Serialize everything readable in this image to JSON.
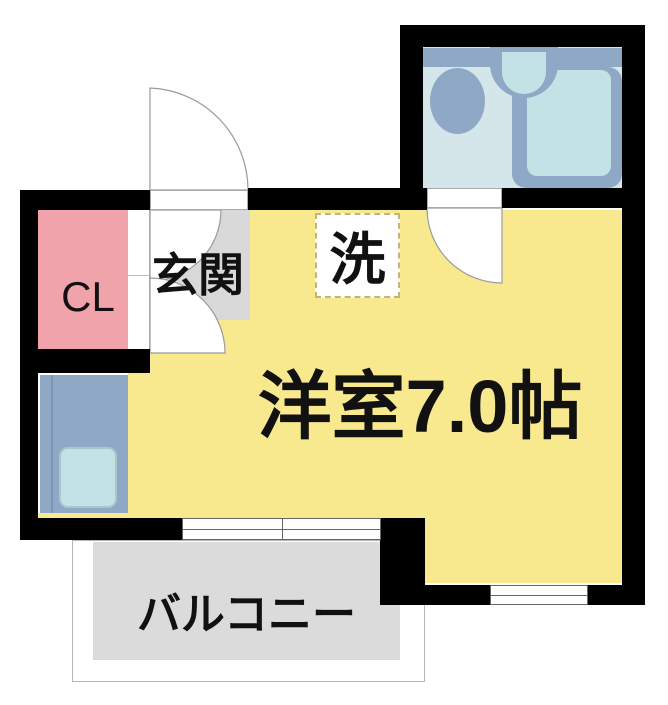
{
  "image_type": "apartment-floor-plan",
  "labels": {
    "closet": "CL",
    "entrance": "玄関",
    "laundry": "洗",
    "main_room": "洋室7.0帖",
    "balcony": "バルコニー"
  },
  "icons": {
    "toilet": "toilet-icon",
    "washbasin": "washbasin-icon",
    "bathtub": "bathtub-icon",
    "kitchen_sink": "kitchen-sink-icon",
    "entrance_door": "door-swing-icon",
    "bathroom_door": "door-swing-icon"
  },
  "colors": {
    "wall": "#000000",
    "room_yellow": "#F8E88E",
    "closet_pink": "#F0A3AB",
    "entrance_gray": "#D9D9D9",
    "balcony_gray": "#DBDBDB",
    "fixture_blue": "#8FA8C6",
    "fixture_cyan": "#C2E2E5",
    "bath_floor": "#D5E6EA",
    "line_gray": "#9B9B9B",
    "text_black": "#111111"
  }
}
